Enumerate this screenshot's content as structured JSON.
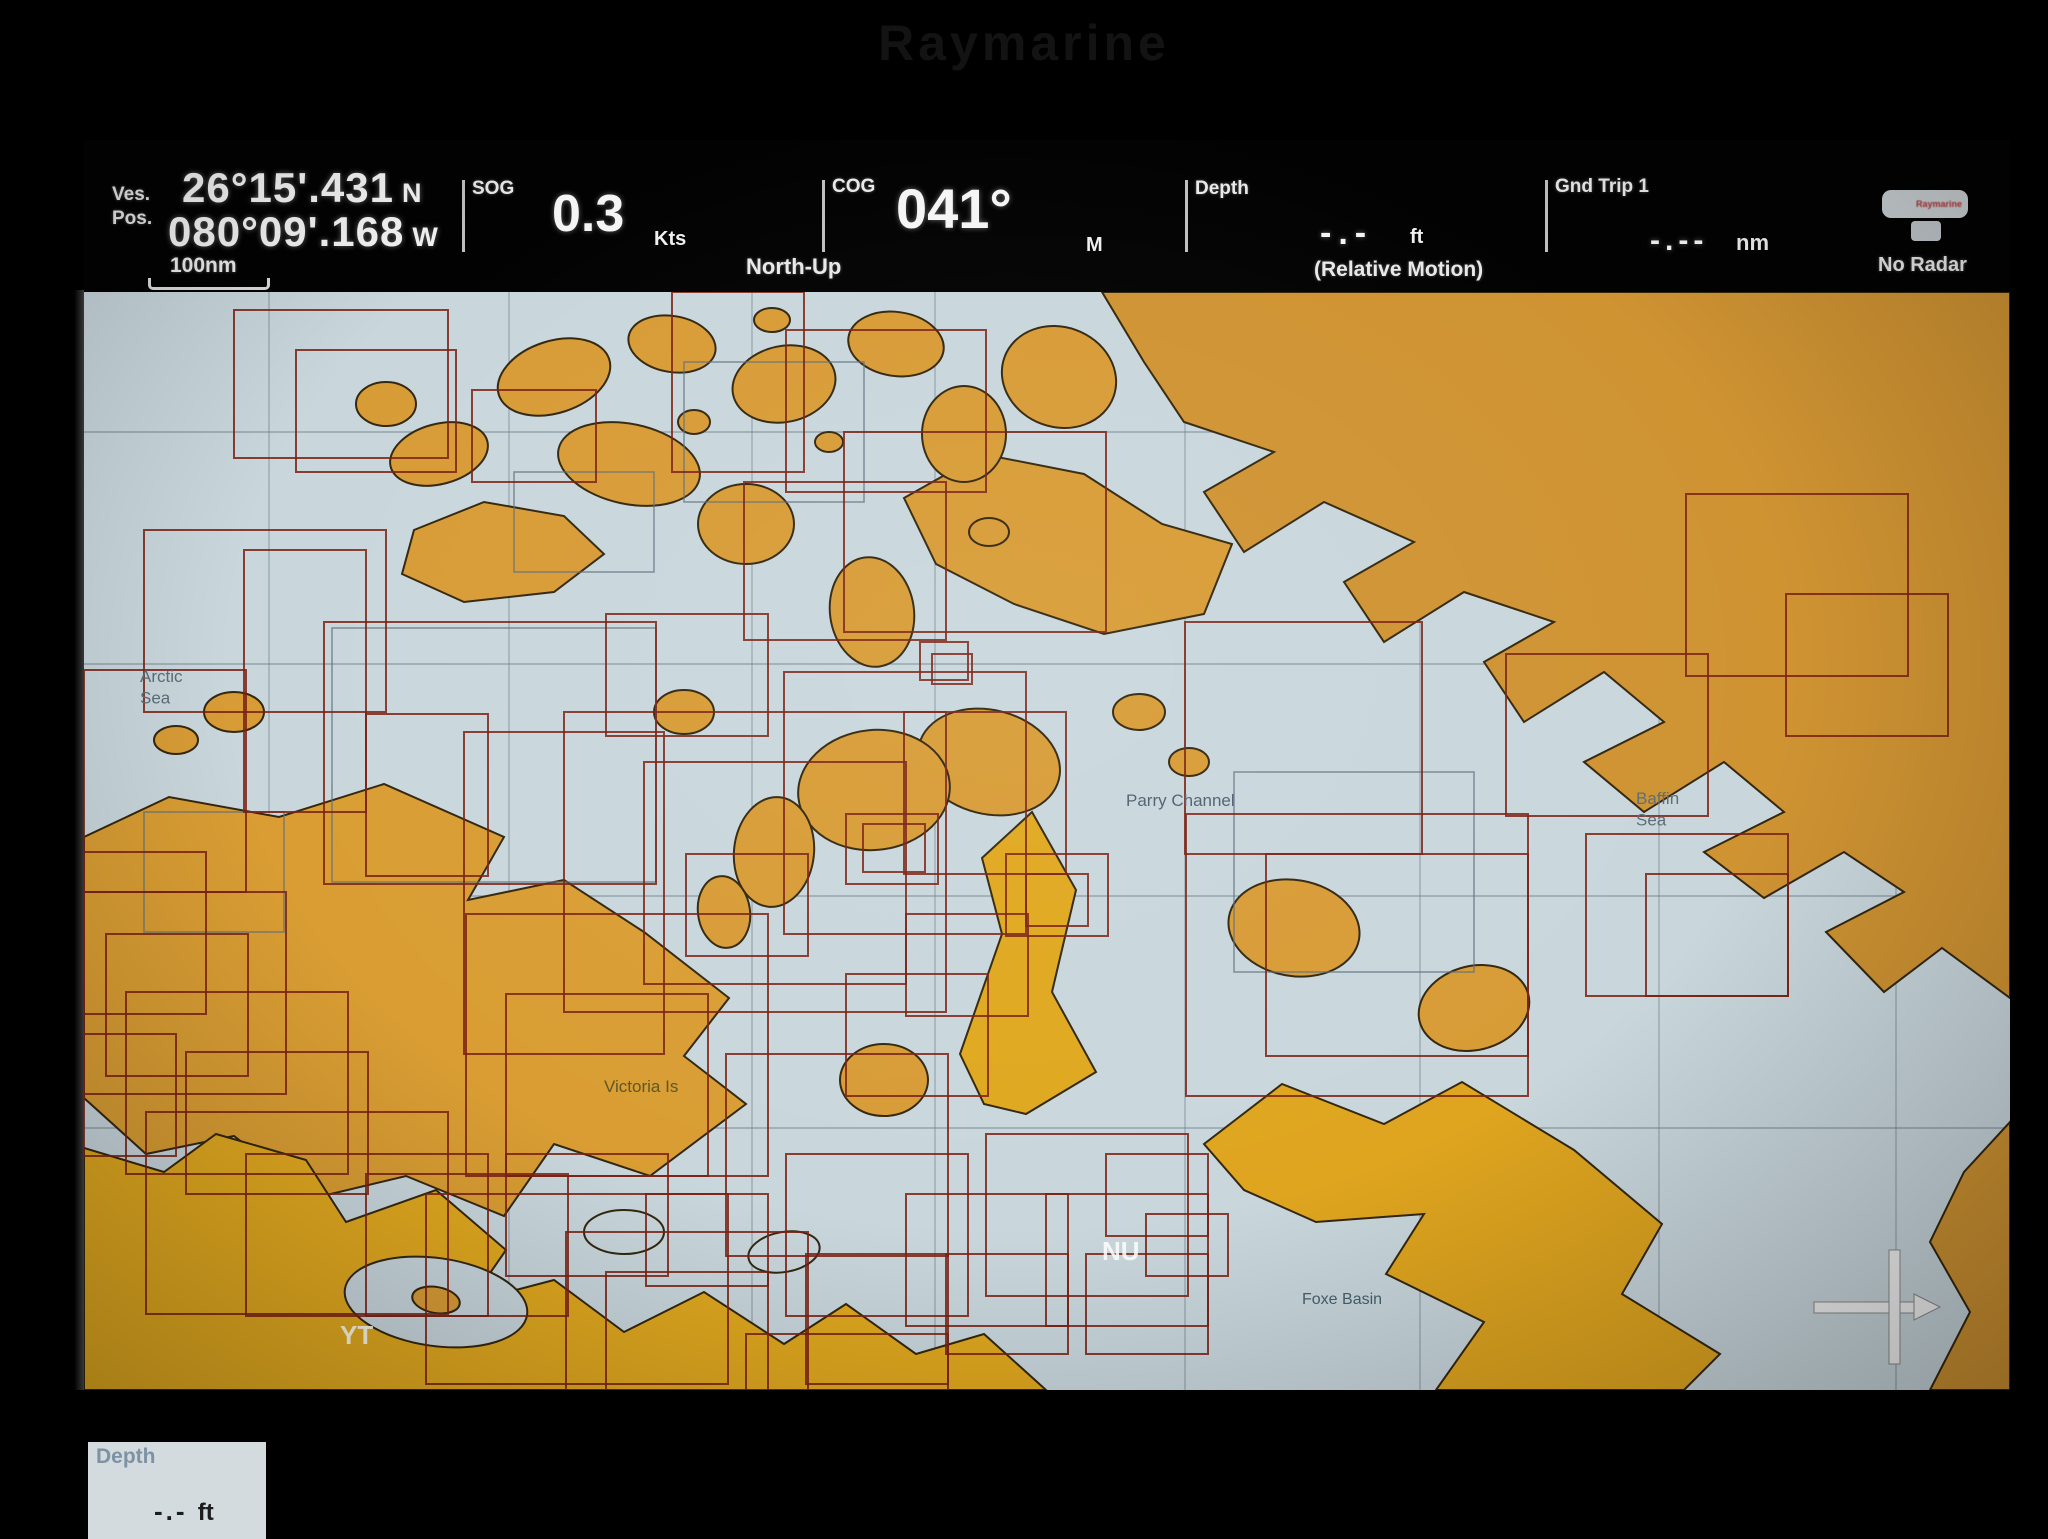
{
  "device": {
    "brand": "Raymarine"
  },
  "databar": {
    "position": {
      "label_line1": "Ves.",
      "label_line2": "Pos.",
      "lat": "26°15'.431",
      "lat_hemi": "N",
      "lon": "080°09'.168",
      "lon_hemi": "W"
    },
    "scale_bar": {
      "label": "100nm"
    },
    "sog": {
      "label": "SOG",
      "value": "0.3",
      "unit": "Kts"
    },
    "orientation_label": "North-Up",
    "cog": {
      "label": "COG",
      "value": "041°",
      "unit": "M"
    },
    "depth": {
      "label": "Depth",
      "value": "-.-",
      "unit": "ft",
      "mode": "(Relative Motion)"
    },
    "gnd_trip": {
      "label": "Gnd Trip 1",
      "value": "-.--",
      "unit": "nm"
    },
    "radar": {
      "icon_text": "Raymarine",
      "status": "No Radar"
    }
  },
  "map": {
    "colors": {
      "sea": "#c9d7dd",
      "outline": "#33270f",
      "chart_rect": "#7b2113",
      "chart_rect_gray": "#5e6f7e",
      "graticule": "#5f7078",
      "land_top": "#d89c36",
      "land_right": "#cf9332",
      "land_mid": "#d99d33",
      "land_bottom": "#e0a81f"
    },
    "graticule": {
      "h": [
        140,
        372,
        604,
        836
      ],
      "v": [
        185,
        425,
        668,
        851,
        1101,
        1336,
        1575,
        1812
      ]
    },
    "landmasses": [
      {
        "name": "greenland-ellesmere",
        "fill": "#cf9332",
        "points": [
          [
            1018,
            0
          ],
          [
            1926,
            0
          ],
          [
            1926,
            706
          ],
          [
            1858,
            656
          ],
          [
            1800,
            700
          ],
          [
            1742,
            640
          ],
          [
            1820,
            600
          ],
          [
            1760,
            560
          ],
          [
            1680,
            606
          ],
          [
            1620,
            560
          ],
          [
            1700,
            520
          ],
          [
            1640,
            470
          ],
          [
            1560,
            520
          ],
          [
            1500,
            470
          ],
          [
            1580,
            430
          ],
          [
            1520,
            380
          ],
          [
            1440,
            430
          ],
          [
            1400,
            370
          ],
          [
            1470,
            330
          ],
          [
            1380,
            300
          ],
          [
            1300,
            350
          ],
          [
            1260,
            290
          ],
          [
            1330,
            250
          ],
          [
            1240,
            210
          ],
          [
            1160,
            260
          ],
          [
            1120,
            200
          ],
          [
            1190,
            160
          ],
          [
            1100,
            130
          ],
          [
            1060,
            70
          ]
        ]
      },
      {
        "name": "greenland-south-wedge",
        "fill": "#cf9332",
        "points": [
          [
            1926,
            830
          ],
          [
            1926,
            1098
          ],
          [
            1846,
            1098
          ],
          [
            1886,
            1020
          ],
          [
            1846,
            950
          ],
          [
            1880,
            880
          ]
        ]
      },
      {
        "name": "banks-victoria-island",
        "fill": "#d99d33",
        "points": [
          [
            0,
            545
          ],
          [
            85,
            505
          ],
          [
            195,
            525
          ],
          [
            300,
            492
          ],
          [
            420,
            545
          ],
          [
            384,
            608
          ],
          [
            480,
            588
          ],
          [
            560,
            640
          ],
          [
            645,
            706
          ],
          [
            600,
            764
          ],
          [
            662,
            812
          ],
          [
            566,
            884
          ],
          [
            470,
            852
          ],
          [
            420,
            924
          ],
          [
            322,
            884
          ],
          [
            230,
            906
          ],
          [
            150,
            844
          ],
          [
            62,
            862
          ],
          [
            0,
            806
          ]
        ]
      },
      {
        "name": "mainland-south",
        "fill": "#e0a81f",
        "points": [
          [
            0,
            856
          ],
          [
            80,
            880
          ],
          [
            132,
            842
          ],
          [
            222,
            868
          ],
          [
            262,
            930
          ],
          [
            352,
            898
          ],
          [
            422,
            958
          ],
          [
            386,
            1010
          ],
          [
            470,
            988
          ],
          [
            540,
            1040
          ],
          [
            620,
            1000
          ],
          [
            700,
            1052
          ],
          [
            762,
            1012
          ],
          [
            832,
            1062
          ],
          [
            900,
            1042
          ],
          [
            962,
            1098
          ],
          [
            0,
            1098
          ]
        ]
      },
      {
        "name": "boothia-peninsula",
        "fill": "#e0a81f",
        "points": [
          [
            876,
            762
          ],
          [
            918,
            642
          ],
          [
            898,
            566
          ],
          [
            948,
            520
          ],
          [
            992,
            598
          ],
          [
            968,
            700
          ],
          [
            1012,
            780
          ],
          [
            942,
            822
          ],
          [
            900,
            812
          ]
        ]
      },
      {
        "name": "baffin-island",
        "fill": "#dfa51f",
        "points": [
          [
            1120,
            852
          ],
          [
            1198,
            792
          ],
          [
            1300,
            832
          ],
          [
            1378,
            790
          ],
          [
            1490,
            858
          ],
          [
            1578,
            932
          ],
          [
            1538,
            1002
          ],
          [
            1636,
            1062
          ],
          [
            1600,
            1098
          ],
          [
            1352,
            1098
          ],
          [
            1400,
            1030
          ],
          [
            1302,
            982
          ],
          [
            1340,
            922
          ],
          [
            1232,
            930
          ],
          [
            1160,
            898
          ]
        ]
      },
      {
        "name": "devon-island",
        "fill": "#d89c36",
        "points": [
          [
            820,
            206
          ],
          [
            898,
            162
          ],
          [
            1000,
            182
          ],
          [
            1078,
            232
          ],
          [
            1148,
            252
          ],
          [
            1120,
            322
          ],
          [
            1020,
            342
          ],
          [
            930,
            312
          ],
          [
            852,
            272
          ]
        ]
      },
      {
        "name": "melville-island",
        "fill": "#d89c36",
        "points": [
          [
            330,
            238
          ],
          [
            400,
            210
          ],
          [
            480,
            224
          ],
          [
            520,
            262
          ],
          [
            470,
            300
          ],
          [
            380,
            310
          ],
          [
            318,
            282
          ]
        ]
      }
    ],
    "inlets": [
      {
        "name": "coronation-gulf",
        "cx": 352,
        "cy": 1010,
        "rx": 92,
        "ry": 44,
        "rot": 8
      },
      {
        "name": "queen-maud-gulf",
        "cx": 700,
        "cy": 960,
        "rx": 36,
        "ry": 20,
        "rot": -10
      },
      {
        "name": "chantrey-inlet",
        "cx": 540,
        "cy": 940,
        "rx": 40,
        "ry": 22,
        "rot": 0
      }
    ],
    "islands": [
      {
        "cx": 470,
        "cy": 85,
        "rx": 58,
        "ry": 36,
        "rot": -18
      },
      {
        "cx": 588,
        "cy": 52,
        "rx": 44,
        "ry": 28,
        "rot": 10
      },
      {
        "cx": 700,
        "cy": 92,
        "rx": 52,
        "ry": 38,
        "rot": -12
      },
      {
        "cx": 812,
        "cy": 52,
        "rx": 48,
        "ry": 32,
        "rot": 8
      },
      {
        "cx": 880,
        "cy": 142,
        "rx": 42,
        "ry": 48,
        "rot": 0
      },
      {
        "cx": 975,
        "cy": 85,
        "rx": 58,
        "ry": 50,
        "rot": 20
      },
      {
        "cx": 302,
        "cy": 112,
        "rx": 30,
        "ry": 22,
        "rot": 0
      },
      {
        "cx": 355,
        "cy": 162,
        "rx": 50,
        "ry": 30,
        "rot": -15
      },
      {
        "cx": 545,
        "cy": 172,
        "rx": 72,
        "ry": 40,
        "rot": 12
      },
      {
        "cx": 662,
        "cy": 232,
        "rx": 48,
        "ry": 40,
        "rot": 0
      },
      {
        "cx": 788,
        "cy": 320,
        "rx": 42,
        "ry": 55,
        "rot": -8
      },
      {
        "cx": 905,
        "cy": 470,
        "rx": 72,
        "ry": 52,
        "rot": 14
      },
      {
        "cx": 790,
        "cy": 498,
        "rx": 76,
        "ry": 60,
        "rot": -6
      },
      {
        "cx": 800,
        "cy": 788,
        "rx": 44,
        "ry": 36,
        "rot": 0
      },
      {
        "cx": 1210,
        "cy": 636,
        "rx": 66,
        "ry": 48,
        "rot": 10
      },
      {
        "cx": 1390,
        "cy": 716,
        "rx": 56,
        "ry": 42,
        "rot": -14
      },
      {
        "cx": 610,
        "cy": 130,
        "rx": 16,
        "ry": 12,
        "rot": 0
      },
      {
        "cx": 745,
        "cy": 150,
        "rx": 14,
        "ry": 10,
        "rot": 0
      },
      {
        "cx": 688,
        "cy": 28,
        "rx": 18,
        "ry": 12,
        "rot": 0
      },
      {
        "cx": 905,
        "cy": 240,
        "rx": 20,
        "ry": 14,
        "rot": 0
      },
      {
        "cx": 1055,
        "cy": 420,
        "rx": 26,
        "ry": 18,
        "rot": 0
      },
      {
        "cx": 1105,
        "cy": 470,
        "rx": 20,
        "ry": 14,
        "rot": 0
      },
      {
        "cx": 150,
        "cy": 420,
        "rx": 30,
        "ry": 20,
        "rot": 0
      },
      {
        "cx": 92,
        "cy": 448,
        "rx": 22,
        "ry": 14,
        "rot": 0
      },
      {
        "cx": 352,
        "cy": 1008,
        "rx": 24,
        "ry": 13,
        "rot": 10
      },
      {
        "cx": 600,
        "cy": 420,
        "rx": 30,
        "ry": 22,
        "rot": 0
      },
      {
        "cx": 690,
        "cy": 560,
        "rx": 40,
        "ry": 55,
        "rot": 6
      },
      {
        "cx": 640,
        "cy": 620,
        "rx": 26,
        "ry": 36,
        "rot": -8
      }
    ],
    "chart_rects": [
      [
        150,
        18,
        214,
        148
      ],
      [
        212,
        58,
        160,
        122
      ],
      [
        388,
        98,
        124,
        92
      ],
      [
        60,
        238,
        242,
        182
      ],
      [
        160,
        258,
        122,
        262
      ],
      [
        240,
        330,
        332,
        262
      ],
      [
        0,
        378,
        162,
        222
      ],
      [
        588,
        0,
        132,
        180
      ],
      [
        702,
        38,
        200,
        162
      ],
      [
        760,
        140,
        262,
        200
      ],
      [
        660,
        190,
        202,
        158
      ],
      [
        480,
        420,
        382,
        300
      ],
      [
        560,
        470,
        262,
        222
      ],
      [
        380,
        440,
        200,
        322
      ],
      [
        700,
        380,
        242,
        262
      ],
      [
        820,
        420,
        162,
        162
      ],
      [
        762,
        522,
        92,
        70
      ],
      [
        779,
        532,
        62,
        48
      ],
      [
        836,
        350,
        48,
        38
      ],
      [
        848,
        362,
        40,
        30
      ],
      [
        0,
        560,
        122,
        162
      ],
      [
        0,
        600,
        202,
        202
      ],
      [
        22,
        642,
        142,
        142
      ],
      [
        42,
        700,
        222,
        182
      ],
      [
        102,
        760,
        182,
        142
      ],
      [
        0,
        742,
        92,
        122
      ],
      [
        62,
        820,
        302,
        202
      ],
      [
        162,
        862,
        242,
        162
      ],
      [
        282,
        882,
        202,
        142
      ],
      [
        342,
        902,
        302,
        190
      ],
      [
        422,
        862,
        162,
        122
      ],
      [
        382,
        622,
        302,
        262
      ],
      [
        422,
        702,
        202,
        182
      ],
      [
        482,
        940,
        242,
        158
      ],
      [
        522,
        980,
        162,
        118
      ],
      [
        562,
        902,
        122,
        92
      ],
      [
        642,
        762,
        222,
        202
      ],
      [
        702,
        862,
        182,
        162
      ],
      [
        722,
        962,
        142,
        130
      ],
      [
        662,
        1042,
        202,
        56
      ],
      [
        822,
        902,
        162,
        132
      ],
      [
        862,
        962,
        122,
        100
      ],
      [
        902,
        842,
        202,
        162
      ],
      [
        962,
        902,
        162,
        132
      ],
      [
        1002,
        962,
        122,
        100
      ],
      [
        762,
        682,
        142,
        122
      ],
      [
        822,
        622,
        122,
        102
      ],
      [
        1101,
        330,
        237,
        232
      ],
      [
        1182,
        562,
        262,
        202
      ],
      [
        1102,
        522,
        342,
        282
      ],
      [
        1502,
        542,
        202,
        162
      ],
      [
        1562,
        582,
        142,
        122
      ],
      [
        1422,
        362,
        202,
        162
      ],
      [
        1702,
        302,
        162,
        142
      ],
      [
        1602,
        202,
        222,
        182
      ],
      [
        522,
        322,
        162,
        122
      ],
      [
        282,
        422,
        122,
        162
      ],
      [
        602,
        562,
        122,
        102
      ],
      [
        922,
        562,
        102,
        82
      ],
      [
        942,
        582,
        62,
        52
      ],
      [
        1022,
        862,
        102,
        82
      ],
      [
        1062,
        922,
        82,
        62
      ]
    ],
    "chart_rects_gray": [
      [
        600,
        70,
        180,
        140
      ],
      [
        1150,
        480,
        240,
        200
      ],
      [
        60,
        520,
        140,
        120
      ],
      [
        430,
        180,
        140,
        100
      ],
      [
        248,
        336,
        324,
        254
      ]
    ],
    "labels": [
      {
        "lines": [
          "Arctic",
          "Sea"
        ],
        "x": 56,
        "y": 390,
        "size": 17,
        "color": "#5d6e78",
        "weight": "normal"
      },
      {
        "lines": [
          "Parry Channel"
        ],
        "x": 1042,
        "y": 514,
        "size": 17,
        "color": "#4f6070",
        "weight": "normal"
      },
      {
        "lines": [
          "Baffin",
          "Sea"
        ],
        "x": 1552,
        "y": 512,
        "size": 17,
        "color": "#5d6e78",
        "weight": "normal"
      },
      {
        "lines": [
          "Victoria Is"
        ],
        "x": 520,
        "y": 800,
        "size": 17,
        "color": "#5c5822",
        "weight": "normal"
      },
      {
        "lines": [
          "NU"
        ],
        "x": 1018,
        "y": 968,
        "size": 26,
        "color": "rgba(255,255,255,0.88)",
        "weight": "bold"
      },
      {
        "lines": [
          "YT"
        ],
        "x": 256,
        "y": 1052,
        "size": 26,
        "color": "rgba(255,255,255,0.88)",
        "weight": "bold"
      },
      {
        "lines": [
          "Foxe Basin"
        ],
        "x": 1218,
        "y": 1012,
        "size": 16,
        "color": "#47616e",
        "weight": "normal"
      }
    ],
    "cursor": {
      "x": 1810,
      "y": 1015
    },
    "depth_panel": {
      "label": "Depth",
      "value": "-.-",
      "unit": "ft"
    }
  }
}
